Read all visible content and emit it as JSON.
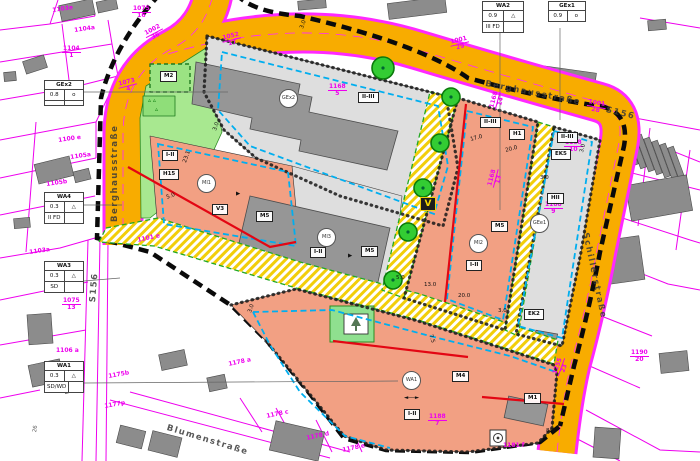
{
  "title": "Bebauungsplan Berghausstraße / Schillerstraße",
  "colors": {
    "road": "#F8AC00",
    "road_edge": "#FF29FF",
    "parcel_line": "#EE00EE",
    "mixed_use_area": "#F2A083",
    "commercial_gray": "#DEDEDE",
    "building": "#969696",
    "green_area": "#A8E890",
    "easement_hatch": "#F2CE0A",
    "baugrenze_blue": "#00AEEF",
    "baulinie_red": "#E30613",
    "plan_boundary": "#0A0A0A",
    "tree_green": "#33CC33"
  },
  "streets": [
    {
      "label": "Berghausstraße",
      "x": 111,
      "y": 222,
      "rot": -90
    },
    {
      "label": "Berghausstraße",
      "x": 486,
      "y": 80,
      "rot": 11
    },
    {
      "label": "Schillerstraße",
      "x": 589,
      "y": 232,
      "rot": 78
    },
    {
      "label": "Blumenstraße",
      "x": 168,
      "y": 424,
      "rot": 17
    },
    {
      "label": "S156",
      "x": 89,
      "y": 302,
      "rot": -85
    },
    {
      "label": "S156",
      "x": 607,
      "y": 106,
      "rot": 14
    }
  ],
  "zone_boxes": [
    {
      "t": "M2",
      "x": 160,
      "y": 71
    },
    {
      "t": "I-II",
      "x": 162,
      "y": 150
    },
    {
      "t": "H15",
      "x": 159,
      "y": 169
    },
    {
      "t": "V3",
      "x": 212,
      "y": 204
    },
    {
      "t": "M5",
      "x": 256,
      "y": 211
    },
    {
      "t": "II-III",
      "x": 358,
      "y": 92
    },
    {
      "t": "I-II",
      "x": 310,
      "y": 247
    },
    {
      "t": "M5",
      "x": 361,
      "y": 246
    },
    {
      "t": "II-III",
      "x": 480,
      "y": 117
    },
    {
      "t": "H1",
      "x": 509,
      "y": 129
    },
    {
      "t": "M5",
      "x": 491,
      "y": 221
    },
    {
      "t": "I-II",
      "x": 466,
      "y": 260
    },
    {
      "t": "II-III",
      "x": 557,
      "y": 132
    },
    {
      "t": "EK5",
      "x": 551,
      "y": 149
    },
    {
      "t": "HII",
      "x": 547,
      "y": 193
    },
    {
      "t": "EK2",
      "x": 524,
      "y": 309
    },
    {
      "t": "M4",
      "x": 452,
      "y": 371
    },
    {
      "t": "M1",
      "x": 524,
      "y": 393
    },
    {
      "t": "I-II",
      "x": 404,
      "y": 409
    }
  ],
  "zone_circles": [
    {
      "t": "GEx2",
      "x": 287,
      "y": 97
    },
    {
      "t": "MI1",
      "x": 205,
      "y": 182
    },
    {
      "t": "MI3",
      "x": 325,
      "y": 236
    },
    {
      "t": "MI2",
      "x": 477,
      "y": 242
    },
    {
      "t": "GEe1",
      "x": 538,
      "y": 222
    },
    {
      "t": "WA1",
      "x": 410,
      "y": 379
    }
  ],
  "v_symbol": {
    "t": "V",
    "x": 420,
    "y": 197
  },
  "ring_symbol": {
    "x": 492,
    "y": 432
  },
  "parcels": [
    {
      "t": "1103e",
      "x": 52,
      "y": 8,
      "r": -8
    },
    {
      "t": "1104a",
      "x": 74,
      "y": 28,
      "r": -8
    },
    {
      "t": "1104",
      "b": "1",
      "x": 62,
      "y": 46
    },
    {
      "t": "1075",
      "b": "16",
      "x": 132,
      "y": 6
    },
    {
      "t": "1002",
      "b": "36",
      "x": 143,
      "y": 32,
      "r": -28
    },
    {
      "t": "1073",
      "b": "4",
      "x": 117,
      "y": 82,
      "r": -14
    },
    {
      "t": "1100 e",
      "x": 58,
      "y": 138,
      "r": -8
    },
    {
      "t": "1105a",
      "x": 70,
      "y": 155,
      "r": -8
    },
    {
      "t": "1105b",
      "x": 46,
      "y": 182,
      "r": -8
    },
    {
      "t": "1103a",
      "x": 29,
      "y": 250,
      "r": -8
    },
    {
      "t": "1075",
      "b": "13",
      "x": 62,
      "y": 298
    },
    {
      "t": "1106 a",
      "x": 56,
      "y": 348
    },
    {
      "t": "1175b",
      "x": 108,
      "y": 374,
      "r": -10
    },
    {
      "t": "1177p",
      "x": 104,
      "y": 404,
      "r": -10
    },
    {
      "t": "1178 a",
      "x": 228,
      "y": 362,
      "r": -12
    },
    {
      "t": "1178 c",
      "x": 266,
      "y": 414,
      "r": -12
    },
    {
      "t": "1178 d",
      "x": 306,
      "y": 436,
      "r": -12
    },
    {
      "t": "1178 e",
      "x": 342,
      "y": 448,
      "r": -12
    },
    {
      "t": "1181 f",
      "x": 503,
      "y": 443
    },
    {
      "t": "1101 e",
      "x": 137,
      "y": 238,
      "r": -12
    },
    {
      "t": "1052",
      "b": "17",
      "x": 221,
      "y": 36,
      "r": -14
    },
    {
      "t": "1001",
      "b": "29",
      "x": 449,
      "y": 40,
      "r": -14
    },
    {
      "t": "1001",
      "b": "28",
      "x": 588,
      "y": 99,
      "r": 10
    },
    {
      "t": "1168",
      "b": "5",
      "x": 328,
      "y": 84
    },
    {
      "t": "1168",
      "b": "14",
      "x": 489,
      "y": 108,
      "r": -75
    },
    {
      "t": "1168",
      "b": "13",
      "x": 487,
      "y": 186,
      "r": -75
    },
    {
      "t": "1188",
      "b": "10",
      "x": 564,
      "y": 140
    },
    {
      "t": "1188",
      "b": "9",
      "x": 544,
      "y": 202
    },
    {
      "t": "1188",
      "b": "7",
      "x": 428,
      "y": 414
    },
    {
      "t": "1255",
      "b": "23",
      "x": 552,
      "y": 374,
      "r": -70
    },
    {
      "t": "1190",
      "b": "20",
      "x": 630,
      "y": 350
    }
  ],
  "dims": [
    {
      "t": "3.0",
      "x": 213,
      "y": 130,
      "r": -70
    },
    {
      "t": "23.1",
      "x": 183,
      "y": 162,
      "r": -70
    },
    {
      "t": "5.0",
      "x": 166,
      "y": 196,
      "r": -20
    },
    {
      "t": "3.0",
      "x": 300,
      "y": 28,
      "r": -70
    },
    {
      "t": "3.0",
      "x": 248,
      "y": 312,
      "r": -70
    },
    {
      "t": "5.0",
      "x": 396,
      "y": 276
    },
    {
      "t": "13.0",
      "x": 424,
      "y": 283
    },
    {
      "t": "20.0",
      "x": 458,
      "y": 294
    },
    {
      "t": "17.0",
      "x": 470,
      "y": 138,
      "r": -15
    },
    {
      "t": "20.0",
      "x": 505,
      "y": 149,
      "r": -15
    },
    {
      "t": "3.0",
      "x": 540,
      "y": 176
    },
    {
      "t": "3.0",
      "x": 498,
      "y": 309
    },
    {
      "t": "8.0",
      "x": 546,
      "y": 429
    },
    {
      "t": "7.5",
      "x": 432,
      "y": 334,
      "r": 72
    },
    {
      "t": "3.0",
      "x": 580,
      "y": 152,
      "r": -75
    },
    {
      "t": "◄──►",
      "x": 404,
      "y": 396
    },
    {
      "t": "▶",
      "x": 236,
      "y": 192
    },
    {
      "t": "▶",
      "x": 348,
      "y": 254
    }
  ],
  "green_marks": [
    {
      "t": "▵  ▵",
      "x": 148,
      "y": 98
    },
    {
      "t": "▵",
      "x": 155,
      "y": 107
    }
  ],
  "house_numbers": [
    {
      "t": "26",
      "x": 33,
      "y": 432,
      "r": -80
    }
  ],
  "tables": [
    {
      "name": "table-gex2",
      "x": 44,
      "y": 80,
      "w": 38,
      "header": "GEx2",
      "rows": [
        [
          "0.8",
          "o"
        ],
        [
          "",
          ""
        ]
      ]
    },
    {
      "name": "table-wa4",
      "x": 44,
      "y": 192,
      "w": 38,
      "header": "WA4",
      "rows": [
        [
          "0.3",
          "△"
        ],
        [
          "II FD",
          ""
        ]
      ]
    },
    {
      "name": "table-wa3",
      "x": 44,
      "y": 261,
      "w": 38,
      "header": "WA3",
      "rows": [
        [
          "0.3",
          "△"
        ],
        [
          "SD",
          ""
        ]
      ]
    },
    {
      "name": "table-wa1",
      "x": 44,
      "y": 361,
      "w": 38,
      "header": "WA1",
      "rows": [
        [
          "0.3",
          "△"
        ],
        [
          "SD/WD",
          ""
        ]
      ]
    },
    {
      "name": "table-wa2",
      "x": 482,
      "y": 1,
      "w": 40,
      "header": "WA2",
      "rows": [
        [
          "0.9",
          "△"
        ],
        [
          "III FD",
          ""
        ]
      ]
    },
    {
      "name": "table-gex1",
      "x": 548,
      "y": 1,
      "w": 36,
      "header": "GEx1",
      "rows": [
        [
          "0.9",
          "o"
        ]
      ]
    }
  ],
  "trees": [
    [
      383,
      68,
      11
    ],
    [
      451,
      97,
      9
    ],
    [
      440,
      143,
      9
    ],
    [
      423,
      188,
      9
    ],
    [
      408,
      232,
      9
    ],
    [
      393,
      280,
      9
    ]
  ],
  "outside_buildings": [
    [
      60,
      2,
      34,
      16,
      -12
    ],
    [
      97,
      0,
      20,
      11,
      -12
    ],
    [
      24,
      58,
      22,
      13,
      -18
    ],
    [
      4,
      72,
      12,
      9,
      -5
    ],
    [
      36,
      160,
      36,
      20,
      -14
    ],
    [
      74,
      170,
      16,
      11,
      -14
    ],
    [
      14,
      218,
      16,
      10,
      -5
    ],
    [
      28,
      314,
      24,
      30,
      -4
    ],
    [
      30,
      362,
      32,
      22,
      -12
    ],
    [
      64,
      380,
      16,
      12,
      -12
    ],
    [
      160,
      352,
      26,
      16,
      -12
    ],
    [
      208,
      376,
      18,
      14,
      -12
    ],
    [
      118,
      428,
      26,
      18,
      14
    ],
    [
      150,
      434,
      30,
      20,
      14
    ],
    [
      272,
      426,
      50,
      30,
      13
    ],
    [
      388,
      0,
      58,
      16,
      -7
    ],
    [
      298,
      0,
      28,
      9,
      -5
    ],
    [
      648,
      20,
      18,
      10,
      -5
    ],
    [
      522,
      68,
      74,
      12,
      8
    ],
    [
      626,
      128,
      6,
      38,
      -20
    ],
    [
      634,
      131,
      6,
      38,
      -20
    ],
    [
      642,
      134,
      6,
      38,
      -20
    ],
    [
      650,
      137,
      6,
      38,
      -20
    ],
    [
      658,
      140,
      6,
      38,
      -20
    ],
    [
      666,
      143,
      6,
      38,
      -20
    ],
    [
      674,
      146,
      6,
      38,
      -20
    ],
    [
      628,
      180,
      62,
      36,
      -10
    ],
    [
      606,
      238,
      36,
      44,
      -8
    ],
    [
      594,
      428,
      26,
      30,
      4
    ],
    [
      660,
      352,
      28,
      20,
      -6
    ]
  ],
  "parcel_lines": [
    "M0,30 L50,24 L95,16",
    "M50,24 L58,0",
    "M95,16 L90,0",
    "M0,62 L112,44",
    "M0,100 L70,88 L118,76",
    "M70,88 L62,24",
    "M118,76 L112,44 L108,20",
    "M0,140 L96,122",
    "M96,122 L118,76",
    "M0,178 L96,158",
    "M96,158 L96,122",
    "M0,215 L95,196",
    "M0,258 L60,248 L95,238",
    "M36,122 L26,252",
    "M88,240 L82,461",
    "M100,240 L96,461",
    "M108,242 L106,461",
    "M0,300 L88,282",
    "M0,345 L86,330",
    "M0,398 L40,390",
    "M110,400 L330,458",
    "M130,392 L350,452",
    "M240,398 L262,432",
    "M276,408 L296,444",
    "M316,420 L332,452",
    "M352,430 L362,452",
    "M624,116 L700,130",
    "M620,130 L700,162",
    "M612,168 L700,190",
    "M604,212 L690,240 L700,243",
    "M597,256 L668,284 L700,290",
    "M586,310 L652,336",
    "M576,360 L640,388",
    "M650,128 L638,226",
    "M690,150 L676,250",
    "M560,430 L620,461",
    "M586,410 L660,450 L700,452",
    "M640,18 L700,28"
  ]
}
